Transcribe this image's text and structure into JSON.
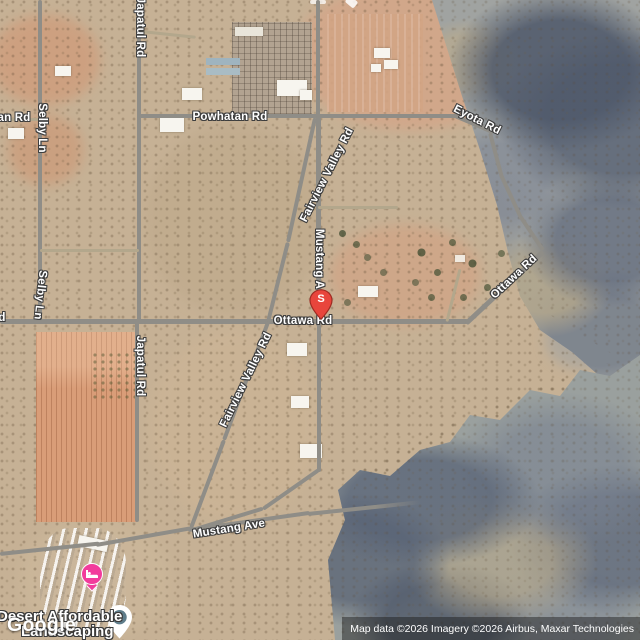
{
  "map": {
    "road_labels": [
      {
        "id": "japatul-rd-north",
        "text": "Japatul Rd"
      },
      {
        "id": "selby-ln-north",
        "text": "Selby Ln"
      },
      {
        "id": "left-edge-road-fragment",
        "text": "an Rd"
      },
      {
        "id": "powhatan-rd",
        "text": "Powhatan Rd"
      },
      {
        "id": "eyota-rd",
        "text": "Eyota Rd"
      },
      {
        "id": "fairview-valley-rd-north",
        "text": "Fairview Valley Rd"
      },
      {
        "id": "mustang-ave-vertical",
        "text": "Mustang A"
      },
      {
        "id": "ottawa-rd-center",
        "text": "Ottawa Rd"
      },
      {
        "id": "ottawa-rd-east",
        "text": "Ottawa Rd"
      },
      {
        "id": "ottawa-rd-west-fragment",
        "text": "d"
      },
      {
        "id": "selby-ln-south",
        "text": "Selby Ln"
      },
      {
        "id": "japatul-rd-south",
        "text": "Japatul Rd"
      },
      {
        "id": "fairview-valley-rd-south",
        "text": "Fairview Valley Rd"
      },
      {
        "id": "mustang-ave-bottom",
        "text": "Mustang Ave"
      }
    ],
    "markers": {
      "s_marker": {
        "label": "S",
        "color": "#E8453C"
      },
      "lodging_pin": {
        "color": "#F23B9C",
        "icon": "bed-icon"
      },
      "business_pin": {
        "color": "#FFFFFF",
        "dot_color": "#5F7D8B"
      }
    },
    "poi_label": {
      "line1": "Desert Affordable",
      "line2": "Landscaping"
    },
    "google_logo": "Google",
    "attribution": "Map data ©2026 Imagery ©2026 Airbus, Maxar Technologies"
  }
}
